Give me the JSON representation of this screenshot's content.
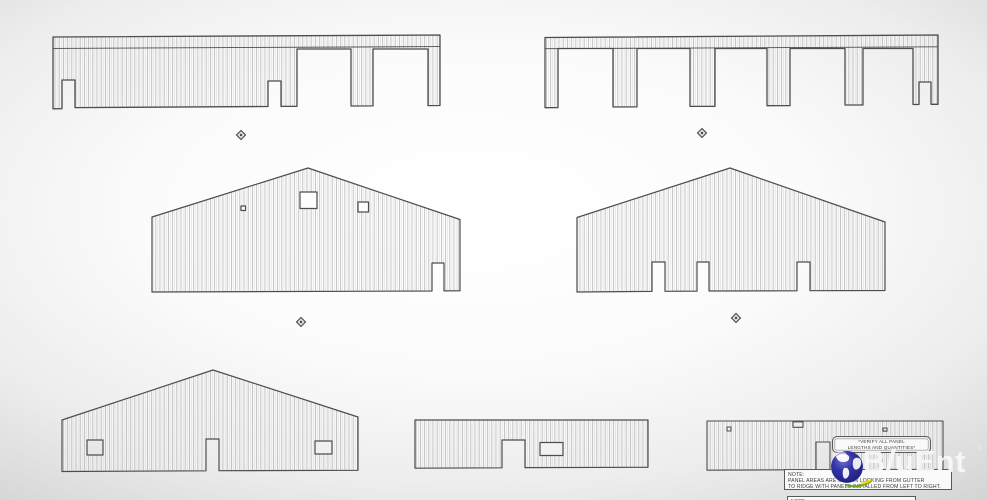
{
  "sheet": {
    "content": "metal building panel elevation drawings",
    "line_color": "#4d4d4d",
    "panel_rib_color": "#9b9b9b"
  },
  "annotations": {
    "verify": {
      "line1": "*VERIFY ALL PANEL",
      "line2": "LENGTHS AND QUANTITIES*"
    },
    "note": {
      "title": "NOTE:",
      "line1": "PANEL AREAS ARE SHOWN LOOKING FROM GUTTER",
      "line2": "TO RIDGE WITH PANELS INSTALLED FROM LEFT TO RIGHT."
    },
    "partial_note": {
      "title": "NOTE:"
    }
  },
  "logo": {
    "name": "BluEnt",
    "part1": "B",
    "part2": "l",
    "part3": "uEnt",
    "registered_mark": "®",
    "globe_color": "#2d2d98",
    "swoosh_green": "#63a81e",
    "swoosh_yellow": "#ffd400",
    "text_color": "#f2f2f2"
  }
}
